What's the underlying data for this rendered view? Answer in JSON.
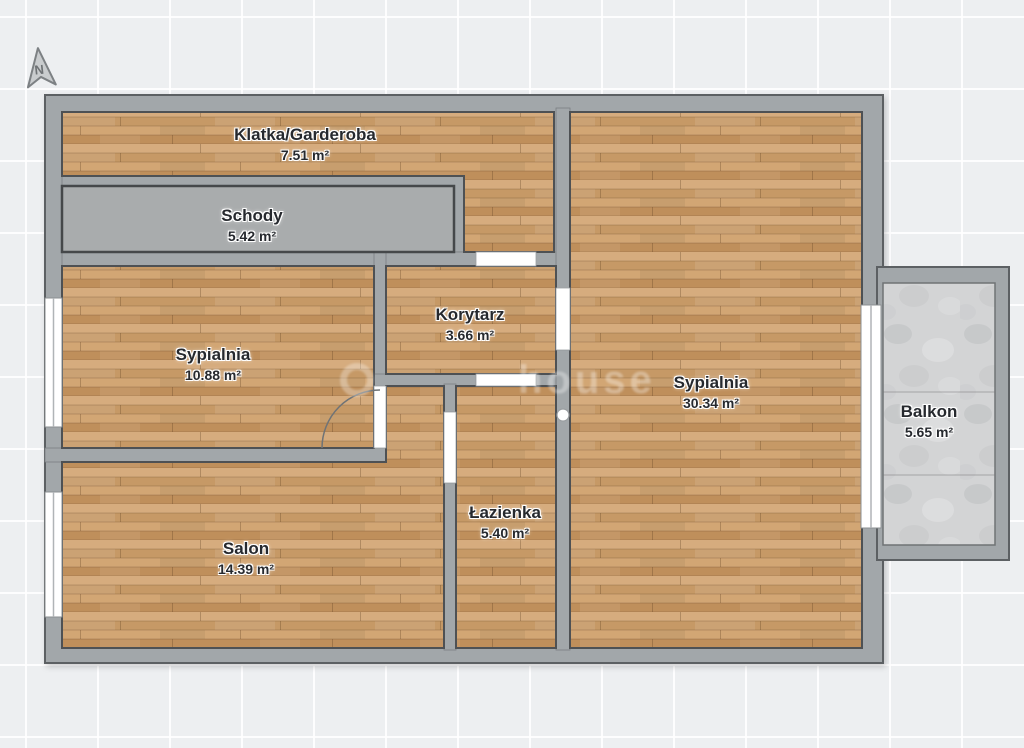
{
  "document": {
    "type": "floor-plan"
  },
  "compass": {
    "label": "N"
  },
  "watermark": {
    "text": "house"
  },
  "rooms": [
    {
      "id": "klatka-garderoba",
      "name": "Klatka/Garderoba",
      "area": "7.51 m²"
    },
    {
      "id": "schody",
      "name": "Schody",
      "area": "5.42 m²"
    },
    {
      "id": "sypialnia-left",
      "name": "Sypialnia",
      "area": "10.88 m²"
    },
    {
      "id": "korytarz",
      "name": "Korytarz",
      "area": "3.66 m²"
    },
    {
      "id": "sypialnia-right",
      "name": "Sypialnia",
      "area": "30.34 m²"
    },
    {
      "id": "lazienka",
      "name": "Łazienka",
      "area": "5.40 m²"
    },
    {
      "id": "salon",
      "name": "Salon",
      "area": "14.39 m²"
    },
    {
      "id": "balkon",
      "name": "Balkon",
      "area": "5.65 m²"
    }
  ],
  "colors": {
    "wall": "#a2a7aa",
    "wall_outline": "#5c6063",
    "floor_wood_base": "#cda377",
    "floor_stairs": "#a9acad",
    "floor_balcony": "#d3d4d5",
    "door_opening": "#ffffff",
    "label_text": "#26292e",
    "background_grid": "#edeff1"
  }
}
